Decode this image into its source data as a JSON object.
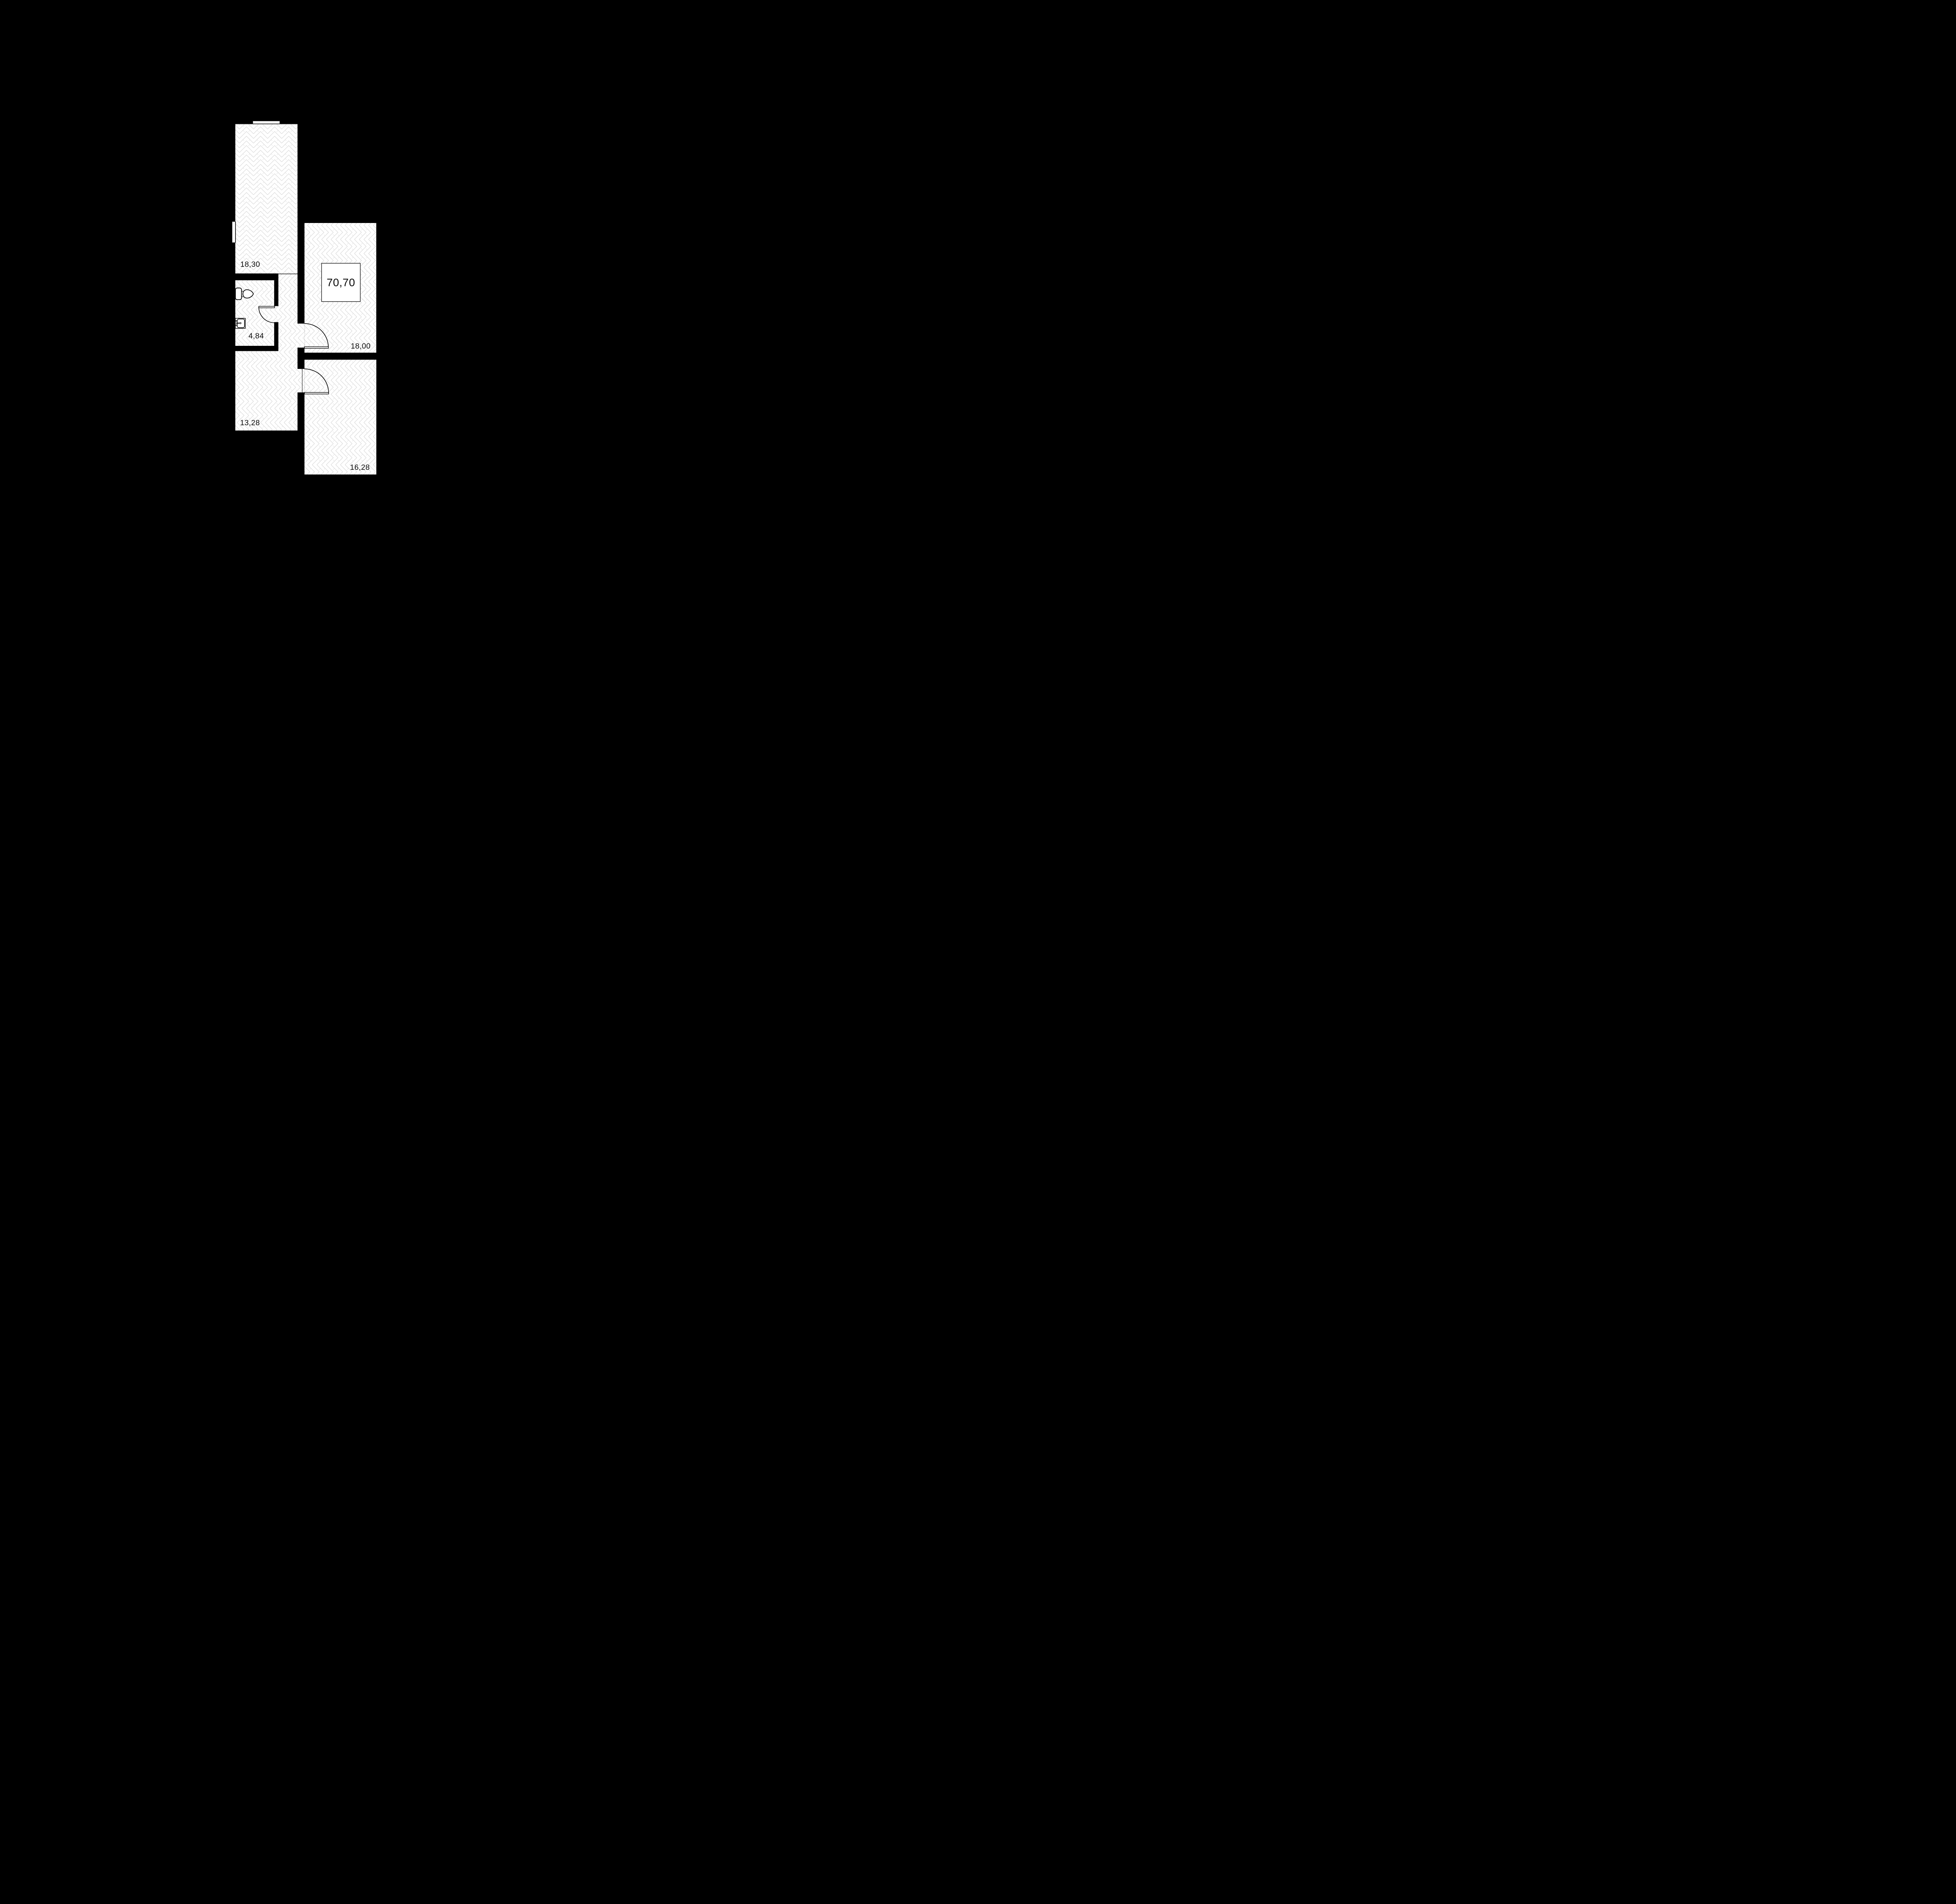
{
  "page": {
    "background_color": "#000000",
    "kind": "apartment floor plan drawing"
  },
  "floorplan": {
    "colors": {
      "wall": "#000000",
      "floor": "#ffffff",
      "hatch_line": "#d6d6d6",
      "label_text": "#0a0a0a"
    },
    "total_area": {
      "value": "70,70"
    },
    "rooms": [
      {
        "id": "room-top",
        "area": "18,30"
      },
      {
        "id": "bathroom",
        "area": "4,84"
      },
      {
        "id": "room-right",
        "area": "18,00"
      },
      {
        "id": "corridor",
        "area": "13,28"
      },
      {
        "id": "room-bottom-right",
        "area": "16,28"
      }
    ],
    "fixtures": [
      "toilet-icon",
      "sink-icon"
    ],
    "door_count": 3,
    "window_count": 1
  }
}
